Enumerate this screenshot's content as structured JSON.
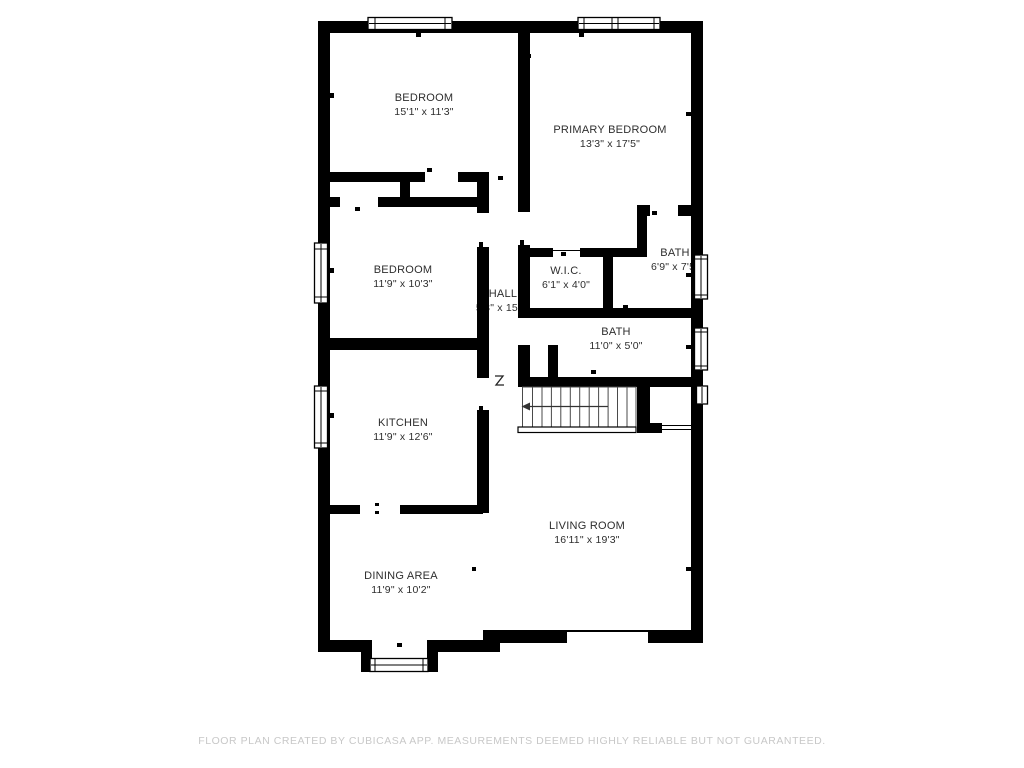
{
  "plan": {
    "rooms": [
      {
        "name": "BEDROOM",
        "dims": "15'1\" x 11'3\""
      },
      {
        "name": "PRIMARY BEDROOM",
        "dims": "13'3\" x 17'5\""
      },
      {
        "name": "BEDROOM",
        "dims": "11'9\" x 10'3\""
      },
      {
        "name": "HALL",
        "dims": "5'3\" x 15'1\""
      },
      {
        "name": "W.I.C.",
        "dims": "6'1\" x 4'0\""
      },
      {
        "name": "BATH",
        "dims": "6'9\" x 7'5\""
      },
      {
        "name": "BATH",
        "dims": "11'0\" x 5'0\""
      },
      {
        "name": "KITCHEN",
        "dims": "11'9\" x 12'6\""
      },
      {
        "name": "LIVING ROOM",
        "dims": "16'11\" x 19'3\""
      },
      {
        "name": "DINING AREA",
        "dims": "11'9\" x 10'2\""
      }
    ],
    "footer": {
      "disclaimer": "FLOOR PLAN CREATED BY CUBICASA APP. MEASUREMENTS DEEMED HIGHLY RELIABLE BUT NOT GUARANTEED."
    },
    "colors": {
      "wall": "#000000",
      "label_text": "#2e2e2e",
      "footer_text": "#c8c8c8",
      "background": "#ffffff"
    }
  }
}
